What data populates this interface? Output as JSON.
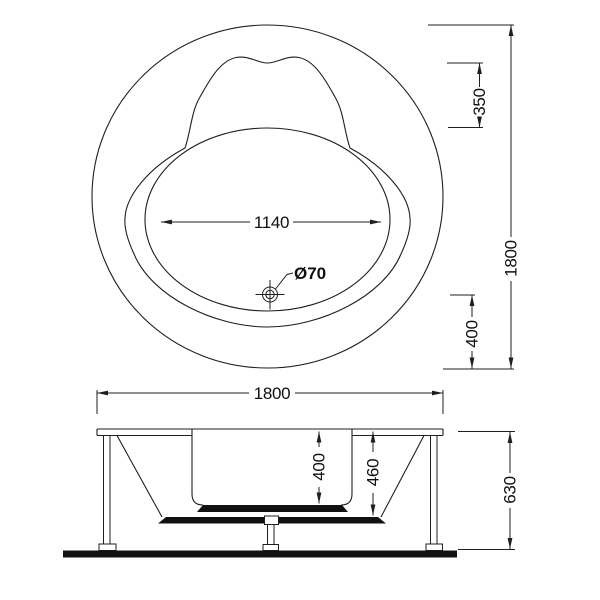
{
  "top_view": {
    "dim_inner_diameter": "1140",
    "dim_drain_diameter": "Ø70",
    "dim_backrest_depth": "350",
    "dim_overall_diameter": "1800",
    "dim_drain_offset": "400"
  },
  "side_view": {
    "dim_overall_width": "1800",
    "dim_basin_depth": "400",
    "dim_shell_depth": "460",
    "dim_total_height": "630"
  },
  "colors": {
    "line": "#1f1f1f",
    "solid_fill": "#111111",
    "background": "#ffffff"
  }
}
